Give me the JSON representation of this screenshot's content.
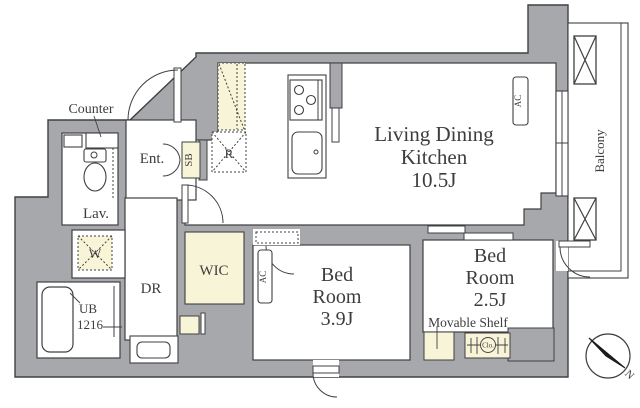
{
  "plan": {
    "type": "apartment-floor-plan",
    "labels": {
      "counter": "Counter",
      "lavatory": "Lav.",
      "entrance": "Ent.",
      "shoe_box": "SB",
      "refrigerator": "R",
      "ldk_line1": "Living Dining",
      "ldk_line2": "Kitchen",
      "ldk_line3": "10.5J",
      "ac": "AC",
      "balcony": "Balcony",
      "bedroom1_line1": "Bed",
      "bedroom1_line2": "Room",
      "bedroom1_line3": "3.9J",
      "bedroom2_line1": "Bed",
      "bedroom2_line2": "Room",
      "bedroom2_line3": "2.5J",
      "movable_shelf": "Movable Shelf",
      "closet": "Clo.",
      "wic": "WIC",
      "dressing_room": "DR",
      "unit_bath_line1": "UB",
      "unit_bath_line2": "1216",
      "washer": "W",
      "compass_north": "N"
    },
    "colors": {
      "wall": "#a6a8ab",
      "storage_cream": "#f8f4d8",
      "line": "#404042",
      "text": "#3d3d3f",
      "background": "#ffffff"
    }
  }
}
